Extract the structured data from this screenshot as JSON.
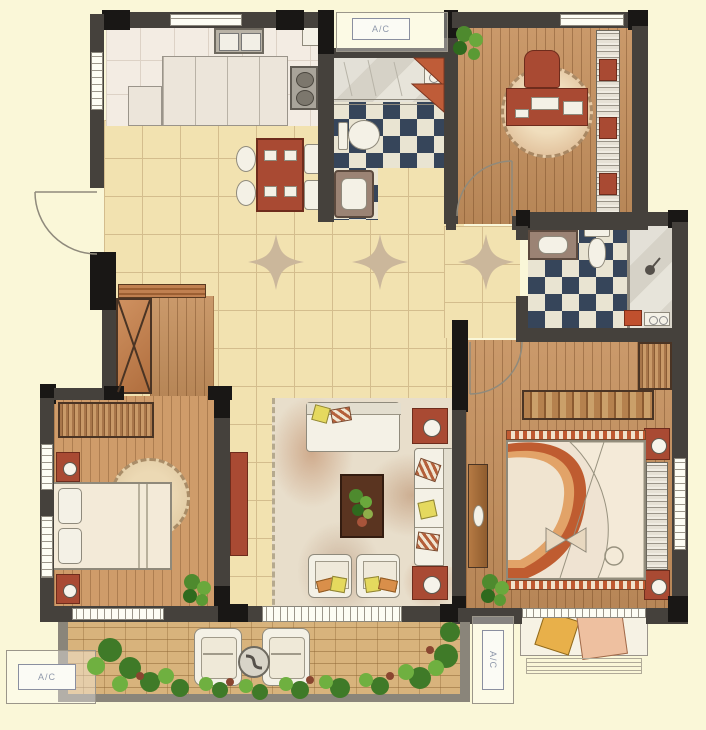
{
  "title": "Residential floor plan (watercolor style)",
  "labels": {
    "ac_top": "A/C",
    "ac_bottom_left": "A/C",
    "ac_bottom_right": "A/C"
  },
  "rooms": [
    {
      "id": "kitchen"
    },
    {
      "id": "dining-area"
    },
    {
      "id": "bathroom-1"
    },
    {
      "id": "study"
    },
    {
      "id": "entry-hall"
    },
    {
      "id": "hall-wardrobe"
    },
    {
      "id": "vestibule"
    },
    {
      "id": "bathroom-2"
    },
    {
      "id": "bedroom-2"
    },
    {
      "id": "living-room"
    },
    {
      "id": "master-bedroom"
    },
    {
      "id": "bay-window"
    },
    {
      "id": "balcony"
    }
  ],
  "colors": {
    "background": "#faf7d8",
    "wall": "#45413c",
    "wallDark": "#191715",
    "tile": "#f2e2b0",
    "tileLine": "#d4bd8d",
    "star": "#cbb79b",
    "kitchenFloor": "#f3ece3",
    "wood": "#c6915e",
    "wood2": "#cf9c6a",
    "checkNavy": "#36455a",
    "checkCream": "#e9e4d2",
    "red": "#a94a33",
    "white": "#f4f1e6",
    "rug": "#e8decb",
    "quilt": "#bf5c30",
    "quiltLight": "#e2a368",
    "green": "#4e8a2e",
    "greenDark": "#2f6a1e",
    "brick": "#d8b37c",
    "acText": "#8f98ab"
  }
}
